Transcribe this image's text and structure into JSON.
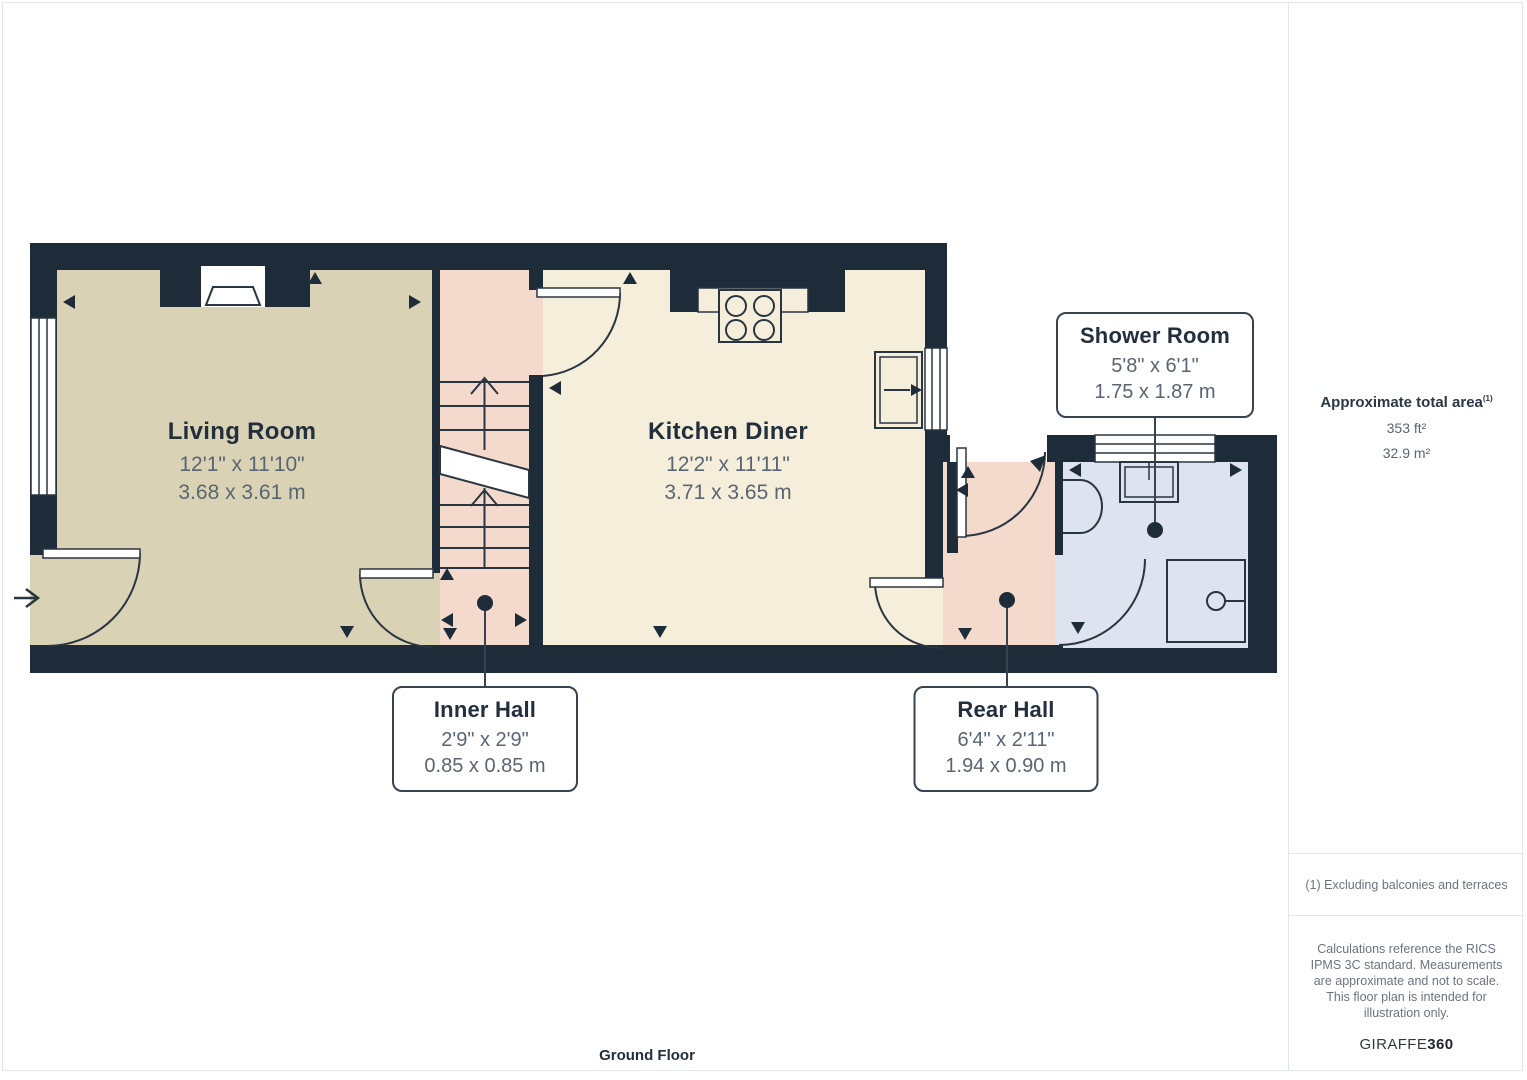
{
  "page": {
    "floor_title": "Ground Floor"
  },
  "rooms": {
    "living": {
      "name": "Living Room",
      "imperial": "12'1\" x 11'10\"",
      "metric": "3.68 x 3.61 m"
    },
    "kitchen": {
      "name": "Kitchen Diner",
      "imperial": "12'2\" x 11'11\"",
      "metric": "3.71 x 3.65 m"
    },
    "shower": {
      "name": "Shower Room",
      "imperial": "5'8\" x 6'1\"",
      "metric": "1.75 x 1.87 m"
    },
    "inner_hall": {
      "name": "Inner Hall",
      "imperial": "2'9\" x 2'9\"",
      "metric": "0.85 x 0.85 m"
    },
    "rear_hall": {
      "name": "Rear Hall",
      "imperial": "6'4\" x 2'11\"",
      "metric": "1.94 x 0.90 m"
    }
  },
  "sidebar": {
    "area_title": "Approximate total area",
    "area_footnote_marker": "(1)",
    "area_imperial": "353 ft²",
    "area_metric": "32.9 m²",
    "footnote": "(1) Excluding balconies and terraces",
    "disclaimer": "Calculations reference the RICS IPMS 3C standard. Measurements are approximate and not to scale. This floor plan is intended for illustration only.",
    "brand_name": "GIRAFFE",
    "brand_suffix": "360"
  },
  "colors": {
    "wall": "#1e2b39",
    "living_floor": "#dad2b4",
    "kitchen_floor": "#f5eeda",
    "hall_floor": "#f4dacc",
    "shower_floor": "#dde3ef",
    "outline": "#2a3542",
    "label_text": "#242f3d",
    "dim_text": "#5a6573",
    "divider": "#e3e5e8"
  }
}
